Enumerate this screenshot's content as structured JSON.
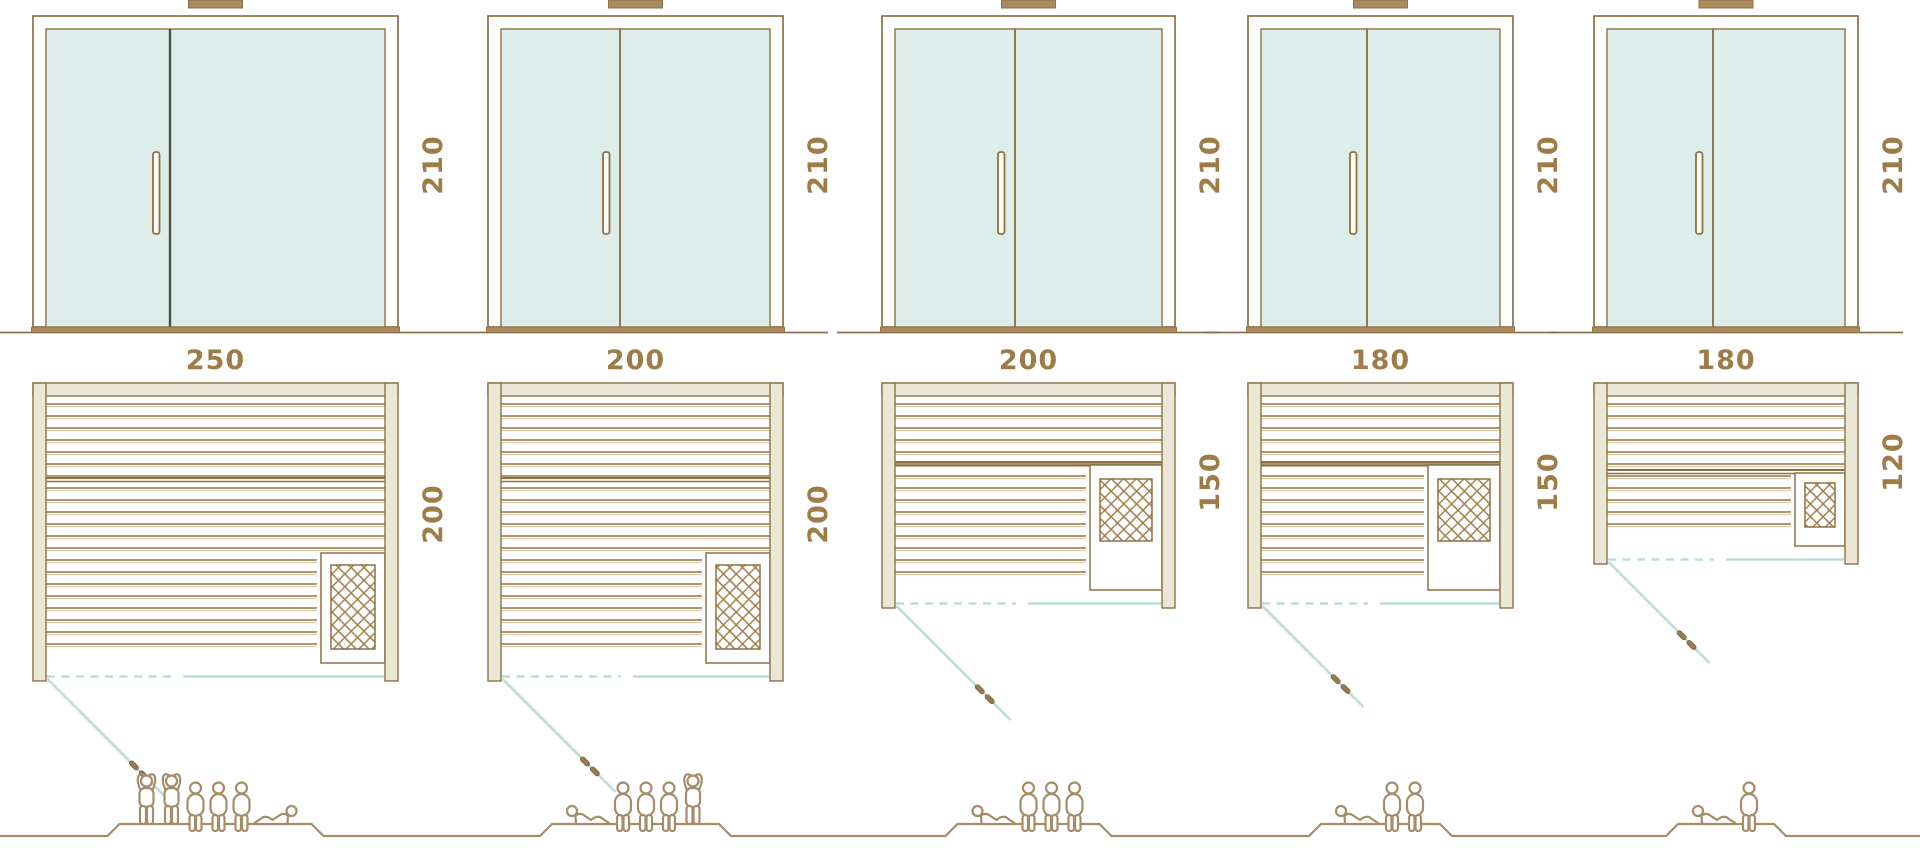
{
  "diagram": {
    "type": "sauna-size-comparison",
    "rows": [
      "front-elevation",
      "floor-plan",
      "capacity-figures"
    ]
  },
  "colors": {
    "line_brown": "#8e7044",
    "board_brown": "#a6875c",
    "board_light": "#d9cab0",
    "wall_beige": "#eae7d4",
    "glass_mint": "#ddeeea",
    "door_teal": "#bcded6",
    "label_brown": "#9d7c48",
    "people_tan": "#a48d68",
    "divider_dark": "#4f4f47",
    "sill_tan": "#ab8a5e"
  },
  "saunas": [
    {
      "name": "sauna-250x200",
      "width_cm": "250",
      "depth_cm": "200",
      "height_cm": "210",
      "capacity": 6,
      "people": [
        "standing",
        "standing",
        "sitting",
        "sitting",
        "sitting",
        "lying-right"
      ]
    },
    {
      "name": "sauna-200x200",
      "width_cm": "200",
      "depth_cm": "200",
      "height_cm": "210",
      "capacity": 5,
      "people": [
        "lying-left",
        "sitting",
        "sitting",
        "sitting",
        "standing"
      ]
    },
    {
      "name": "sauna-200x150",
      "width_cm": "200",
      "depth_cm": "150",
      "height_cm": "210",
      "capacity": 4,
      "people": [
        "lying-left",
        "sitting",
        "sitting",
        "sitting"
      ]
    },
    {
      "name": "sauna-180x150",
      "width_cm": "180",
      "depth_cm": "150",
      "height_cm": "210",
      "capacity": 3,
      "people": [
        "lying-left",
        "sitting",
        "sitting"
      ]
    },
    {
      "name": "sauna-180x120",
      "width_cm": "180",
      "depth_cm": "120",
      "height_cm": "210",
      "capacity": 2,
      "people": [
        "lying-left",
        "sitting"
      ]
    }
  ]
}
